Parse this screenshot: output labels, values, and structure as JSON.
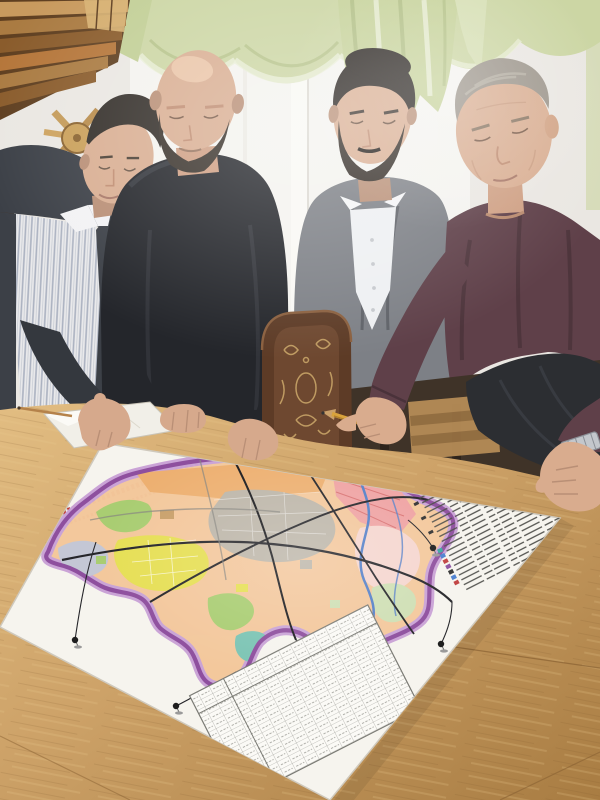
{
  "scene": {
    "kind": "photograph",
    "subject": "four-men-studying-city-master-plan-map-on-table",
    "people_count": 4,
    "map_pins_count": 5,
    "legend_rows_count": 21,
    "illegible_text_regions": [
      "map-title",
      "map-legend",
      "map-data-table"
    ]
  },
  "palette": {
    "wall": "#eae7e2",
    "sheer": "#f4f3ef",
    "frame": "#f9f8f4",
    "frameShade": "#dcd9d2",
    "curtain": "#ccd6a4",
    "curtainHi": "#e9eed6",
    "curtainSh": "#a8b77c",
    "woodA": "#c89a5e",
    "woodB": "#aa7b42",
    "woodC": "#8a5c2c",
    "woodD": "#d8b273",
    "woodGap": "#5f3f20",
    "lattice": "#c49a58",
    "skin": "#d9ae92",
    "skinHi": "#ecc9ab",
    "skinSh": "#b98f76",
    "hairDark": "#332e29",
    "hairDark2": "#292420",
    "hairGray": "#9d968c",
    "hairGrayHi": "#b8b1a5",
    "beard": "#3a332c",
    "jacket1": "#3c4047",
    "sleeve1": "#34383e",
    "shirtStripeBase": "#e9e9eb",
    "stripeInk": "#aab1c0",
    "belt": "#2e3035",
    "sweater2": "#24262b",
    "sweaterFold": "#34373d",
    "blazer": "#7d8086",
    "blazerSh": "#5f6268",
    "shirt3": "#eef0f2",
    "button": "#c6c9cd",
    "sweater4": "#5f4049",
    "sweater4Sh": "#4a323a",
    "trousers": "#2c2e32",
    "trouserHi": "#3c3f45",
    "chairWood": "#5d3b26",
    "chairPanel": "#6e4830",
    "chairCarve": "#c8a468",
    "chairLight": "#b98f58",
    "chairLightSlat": "#9a7344",
    "darkBand": "#3f3328",
    "darkFurn": "#4a3322",
    "table": "#cda268",
    "tableHi": "#e2bd82",
    "tableSh": "#a87c42",
    "seam": "#8a6233",
    "notebook": "#f1efe8",
    "notebookHi": "#fbfaf6",
    "pencil": "#d9a33c",
    "pencilShade": "#b07e2c",
    "pencilTip": "#6b4a2a",
    "poster": "#f6f4ee",
    "posterEdge": "#cfc9bd",
    "titleRed": "#c0392b",
    "legendInk": "#4c4c48",
    "chipTeal": "#3aa8a0",
    "chipBlue": "#4a7fd0",
    "chipRed": "#c04040",
    "chipDark": "#333333",
    "chipPurple": "#8a50a0",
    "mapBase": "#f3c79b",
    "mapOrange": "#edb071",
    "mapYellow": "#e6df55",
    "mapGreen": "#a9cd72",
    "mapTeal": "#7cc4b4",
    "mapPink": "#efa3a3",
    "mapPinkLight": "#f5d6cf",
    "mapPaleGreen": "#cfdfb4",
    "mapGray": "#bdb6a9",
    "mapBlueGray": "#c4c7d5",
    "boundary": "#8e4f9e",
    "boundaryHalo": "#c9a2d6",
    "river": "#5580c8",
    "road": "#26262a",
    "rail": "#1c1c1f",
    "roadGray": "#888680",
    "pinHead": "#1e1e1e",
    "pinBase": "#9a9a9a",
    "watch": "#c3c7cc",
    "watchDark": "#8b9097"
  }
}
